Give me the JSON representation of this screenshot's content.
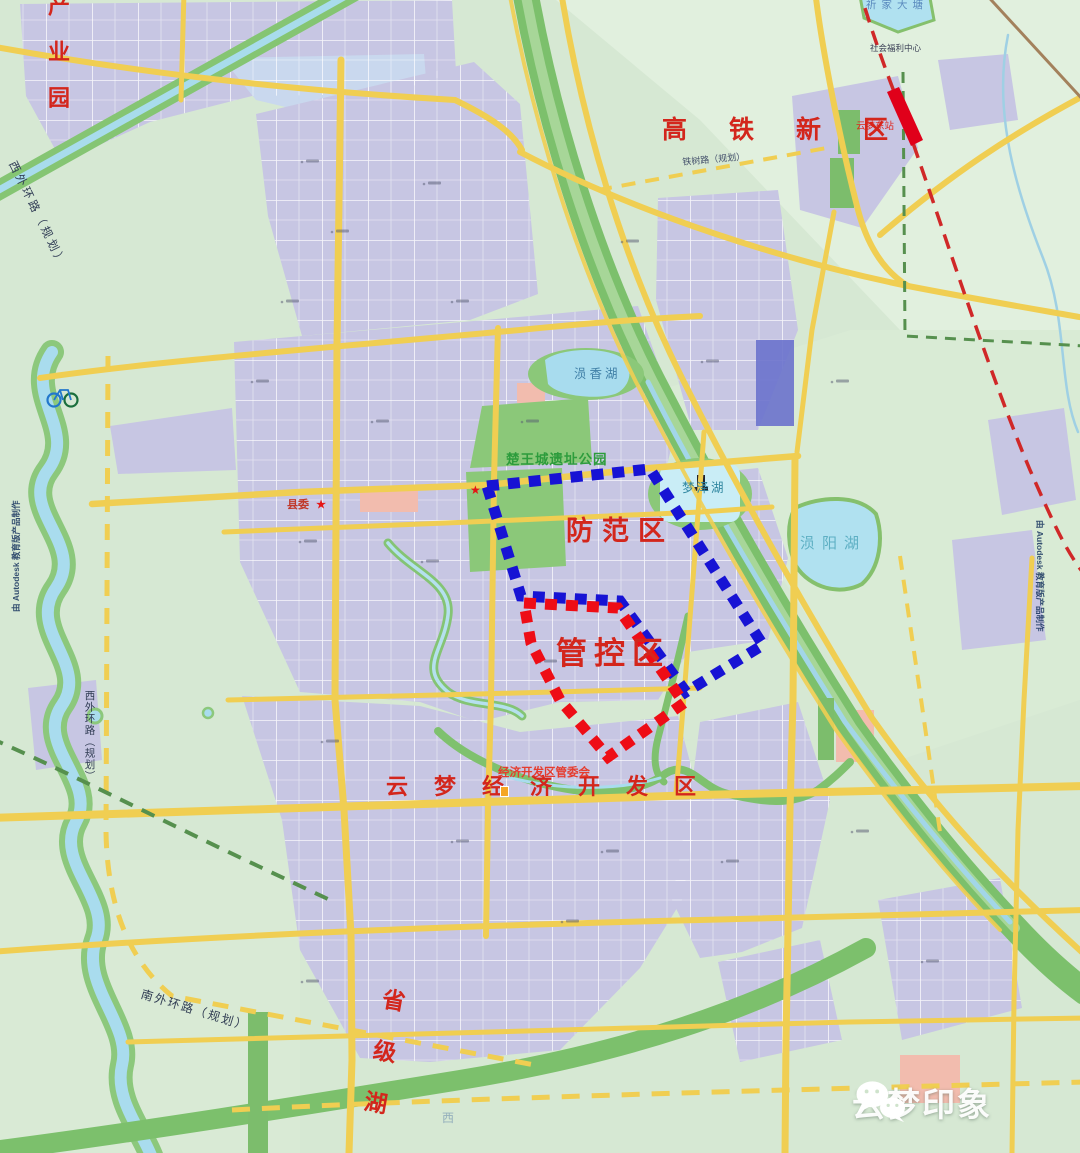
{
  "zones": {
    "prevention": {
      "label": "防范区",
      "color": "#1713d4"
    },
    "control": {
      "label": "管控区",
      "color": "#ee0d16"
    }
  },
  "districts": {
    "industrial_park": "产业园",
    "hsr_new_district": "高铁新区",
    "economic_dev_zone": "云梦经济开发区",
    "provincial_lake": "省级湖"
  },
  "places": {
    "heritage_park": "楚王城遗址公园",
    "mengze_lake": "梦泽湖",
    "yunxiang_lake": "涢香湖",
    "yunyang_lake": "涢阳湖",
    "qijia_pond": "祈家大塘",
    "county_committee": "县委",
    "edz_committee": "经济开发区管委会",
    "east_station": "云梦东站",
    "welfare_center": "社会福利中心",
    "west_char": "西"
  },
  "roads": {
    "west_ring": "西外环路（规划）",
    "south_ring": "南外环路（规划）",
    "tieshu": "铁树路（规划）"
  },
  "station": {
    "bar_color": "#e0001a"
  },
  "icons": {
    "star": "★",
    "wechat": "wechat-icon",
    "bicycle": "bicycle-icon"
  },
  "watermarks": {
    "autodesk": "由 Autodesk 教育版产品制作",
    "brand": "云梦印象"
  }
}
